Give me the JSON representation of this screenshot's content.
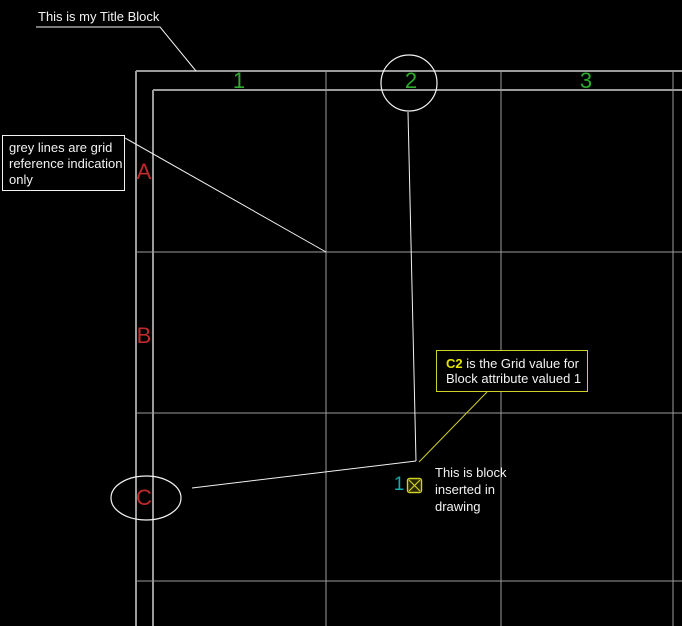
{
  "colors": {
    "background": "#000000",
    "line_grey": "#9b9b9b",
    "leader_white": "#f2f2f2",
    "text_white": "#f2f2f2",
    "grid_label_green": "#2cab2c",
    "grid_label_red": "#bf2a2a",
    "attribute_cyan": "#17a9a9",
    "highlight_yellow": "#e4e400",
    "yellow_line": "#cfcf29"
  },
  "title_block": {
    "columns": [
      {
        "label": "1"
      },
      {
        "label": "2"
      },
      {
        "label": "3"
      }
    ],
    "rows": [
      {
        "label": "A"
      },
      {
        "label": "B"
      },
      {
        "label": "C"
      }
    ]
  },
  "callouts": {
    "title": {
      "text": "This is my Title Block"
    },
    "grid_note": {
      "line1": "grey lines are grid",
      "line2": "reference indication",
      "line3": "only"
    },
    "c2_note": {
      "highlight": "C2",
      "line1_rest": "is the Grid value for",
      "line2": "Block attribute valued 1"
    },
    "block_note": {
      "line1": "This is block",
      "line2": "inserted in",
      "line3": "drawing"
    }
  },
  "block_instance": {
    "attribute_value": "1",
    "symbol": "boxed-x-block-reference-icon"
  }
}
